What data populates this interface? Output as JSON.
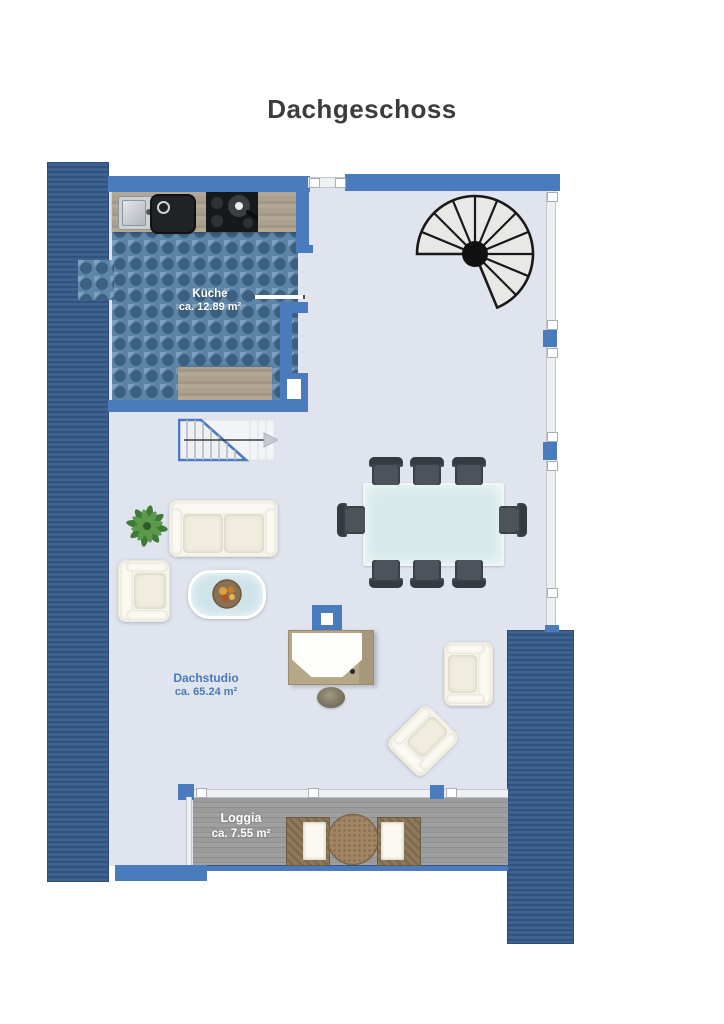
{
  "title": "Dachgeschoss",
  "rooms": {
    "kueche": {
      "name": "Küche",
      "area": "ca. 12.89 m²"
    },
    "dachstudio": {
      "name": "Dachstudio",
      "area": "ca. 65.24 m²"
    },
    "loggia": {
      "name": "Loggia",
      "area": "ca. 7.55 m²"
    }
  },
  "colors": {
    "wall": "#4a7cbd",
    "roof_hatch": "#3a5d8c",
    "floor": "#dfe4ee",
    "kitchen_tile": "#5e86a9",
    "deck": "#969696",
    "label_blue": "#4a7ab5",
    "label_white": "#ffffff",
    "title_text": "#3c3c3c",
    "stair_outline": "#4a7cbd",
    "dining_chair": "#42474d",
    "table_glass": "#d7eaea"
  }
}
